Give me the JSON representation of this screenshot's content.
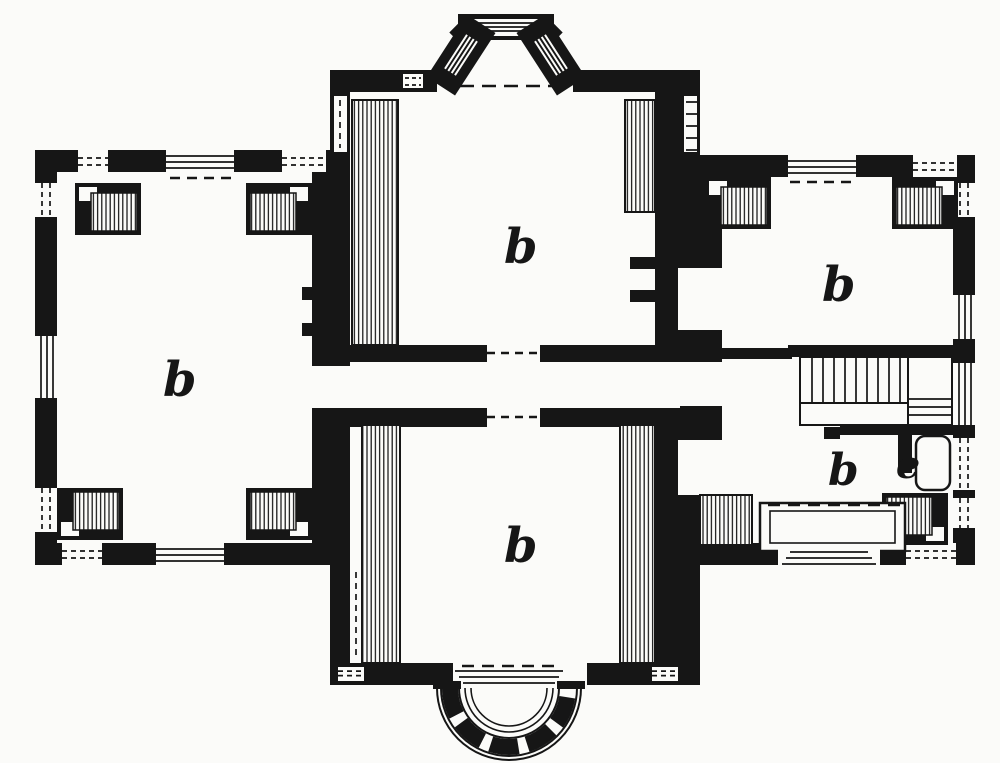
{
  "figure": {
    "type": "floor-plan",
    "style": "19th-century black-ink engraving of a house ground plan",
    "room_labels": [
      {
        "id": "left-room",
        "label": "b"
      },
      {
        "id": "upper-hall",
        "label": "b"
      },
      {
        "id": "lower-hall",
        "label": "b"
      },
      {
        "id": "upper-right-room",
        "label": "b"
      },
      {
        "id": "lower-right-room",
        "label": "b"
      },
      {
        "id": "stair-closet",
        "label": "e"
      }
    ],
    "features": [
      "canted-bay-window-top",
      "semicircular-entrance-steps-bottom",
      "staircase-right-wing",
      "hatched-chimney-masses",
      "triple-line-windows",
      "center-passage-doors"
    ]
  },
  "colors": {
    "ink": "#161616",
    "paper": "#fbfbf9"
  }
}
